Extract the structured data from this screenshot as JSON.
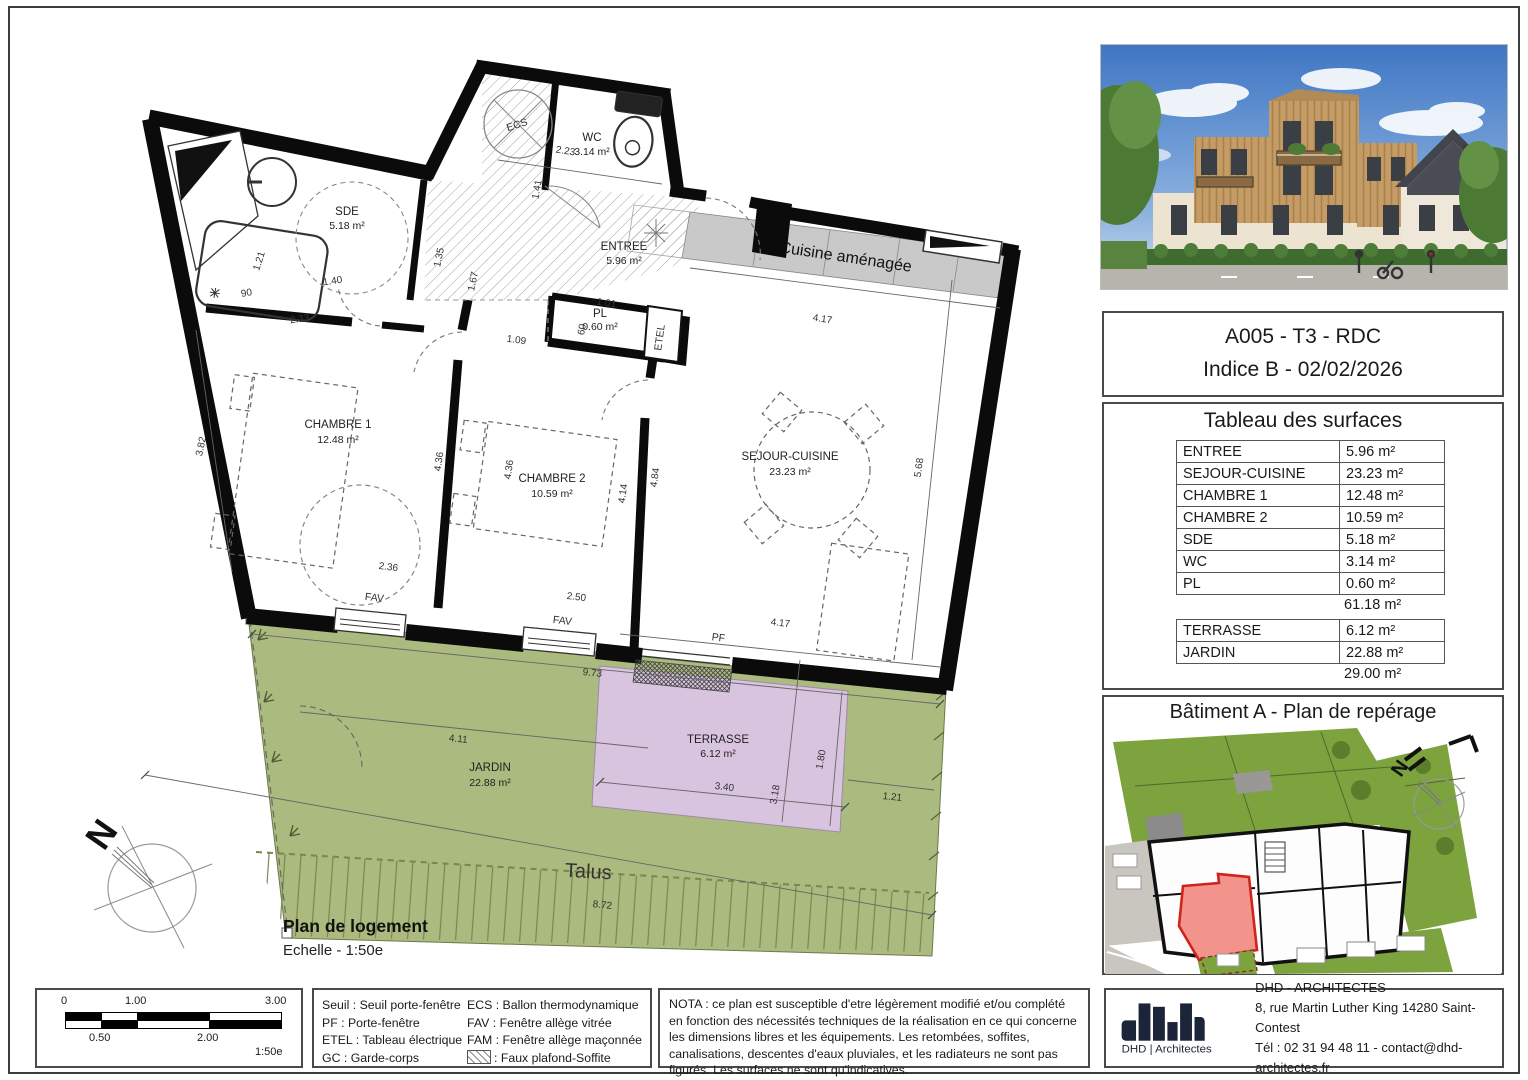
{
  "title_block": {
    "line1": "A005 - T3 - RDC",
    "line2": "Indice B - 02/02/2026"
  },
  "surfaces": {
    "title": "Tableau des surfaces",
    "rows": [
      {
        "label": "ENTREE",
        "value": "5.96 m²"
      },
      {
        "label": "SEJOUR-CUISINE",
        "value": "23.23 m²"
      },
      {
        "label": "CHAMBRE 1",
        "value": "12.48 m²"
      },
      {
        "label": "CHAMBRE 2",
        "value": "10.59 m²"
      },
      {
        "label": "SDE",
        "value": "5.18 m²"
      },
      {
        "label": "WC",
        "value": "3.14 m²"
      },
      {
        "label": "PL",
        "value": "0.60 m²"
      }
    ],
    "subtotal": "61.18 m²",
    "rows2": [
      {
        "label": "TERRASSE",
        "value": "6.12 m²"
      },
      {
        "label": "JARDIN",
        "value": "22.88 m²"
      }
    ],
    "total2": "29.00 m²"
  },
  "reperage": {
    "title": "Bâtiment A - Plan de repérage",
    "north": "N"
  },
  "plan": {
    "caption": {
      "title": "Plan de logement",
      "scale": "Echelle - 1:50e"
    },
    "north": "N",
    "rooms": {
      "wc": {
        "name": "WC",
        "area": "3.14 m²"
      },
      "sde": {
        "name": "SDE",
        "area": "5.18 m²"
      },
      "entree": {
        "name": "ENTREE",
        "area": "5.96 m²"
      },
      "pl": {
        "name": "PL",
        "area": "0.60 m²"
      },
      "chambre1": {
        "name": "CHAMBRE 1",
        "area": "12.48 m²"
      },
      "chambre2": {
        "name": "CHAMBRE 2",
        "area": "10.59 m²"
      },
      "sejour": {
        "name": "SEJOUR-CUISINE",
        "area": "23.23 m²"
      },
      "terrasse": {
        "name": "TERRASSE",
        "area": "6.12 m²"
      },
      "jardin": {
        "name": "JARDIN",
        "area": "22.88 m²"
      }
    },
    "labels": {
      "cuisine": "Cuisine aménagée",
      "etel": "ETEL",
      "ecs": "ECS",
      "talus": "Talus",
      "fav": "FAV",
      "pf": "PF"
    },
    "dims": [
      "2.23",
      "1.41",
      "1.35",
      "1.67",
      "1.09",
      "1.01",
      "60",
      "2.33",
      "1.40",
      "1.21",
      "90",
      "3.82",
      "4.36",
      "2.36",
      "4.36",
      "2.50",
      "4.14",
      "4.84",
      "4.17",
      "5.68",
      "4.17",
      "9.73",
      "4.11",
      "3.40",
      "1.80",
      "3.18",
      "1.21",
      "8.72"
    ]
  },
  "scalebar": {
    "t0": "0",
    "t1": "1.00",
    "t2": "3.00",
    "b1": "0.50",
    "b2": "2.00",
    "ratio": "1:50e"
  },
  "legend": {
    "col1": [
      "Seuil : Seuil porte-fenêtre",
      "PF : Porte-fenêtre",
      "ETEL : Tableau électrique",
      "GC : Garde-corps"
    ],
    "col2": [
      "ECS : Ballon thermodynamique",
      "FAV : Fenêtre allège vitrée",
      "FAM : Fenêtre allège maçonnée",
      ": Faux plafond-Soffite"
    ]
  },
  "nota": "NOTA : ce plan est susceptible d'etre légèrement modifié et/ou complété en fonction des nécessités techniques de la réalisation en ce qui concerne les dimensions libres et les équipements. Les retombées, soffites, canalisations, descentes d'eaux pluviales, et les radiateurs ne sont pas figurés. Les surfaces ne sont qu'indicatives.",
  "firm": {
    "logo_caption": "DHD | Architectes",
    "name": "DHD - ARCHITECTES",
    "address": "8, rue Martin Luther King 14280 Saint-Contest",
    "contact": "Tél : 02 31 94 48 11 - contact@dhd-architectes.fr"
  },
  "colors": {
    "jardin": "#abba7e",
    "terrasse": "#d9c4df",
    "cuisine": "#c9c9c9",
    "map_green": "#7ca33e",
    "map_road": "#c9c6c0",
    "unit_fill": "#f2938c",
    "unit_stroke": "#cf231b",
    "logo": "#1b2438",
    "talus": "#79864f"
  }
}
